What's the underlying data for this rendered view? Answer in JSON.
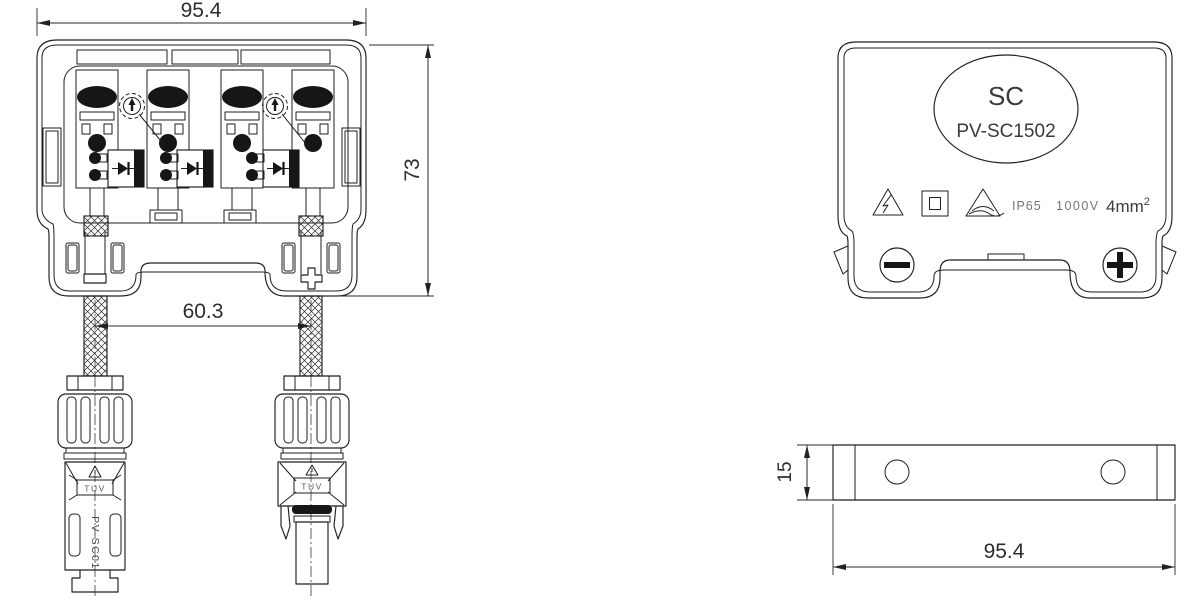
{
  "title": "PV-SC1502 solar junction box — engineering drawing",
  "front_view": {
    "dim_width": "95.4",
    "dim_height": "73",
    "dim_cable_pitch": "60.3",
    "polarity_negative": "−",
    "polarity_positive": "+",
    "connector_female": {
      "cert_label": "TUV",
      "model_label": "PV-SC01"
    },
    "connector_male": {
      "cert_label": "TUV"
    }
  },
  "back_view": {
    "brand": "SC",
    "model": "PV-SC1502",
    "ip_rating": "IP65",
    "max_voltage": "1000V",
    "wire_section_base": "4mm",
    "wire_section_exponent": "2",
    "symbols": [
      "electric-shock-warning",
      "class-ii-double-insulation",
      "caution-notice"
    ]
  },
  "side_view": {
    "dim_height": "15",
    "dim_width": "95.4"
  }
}
